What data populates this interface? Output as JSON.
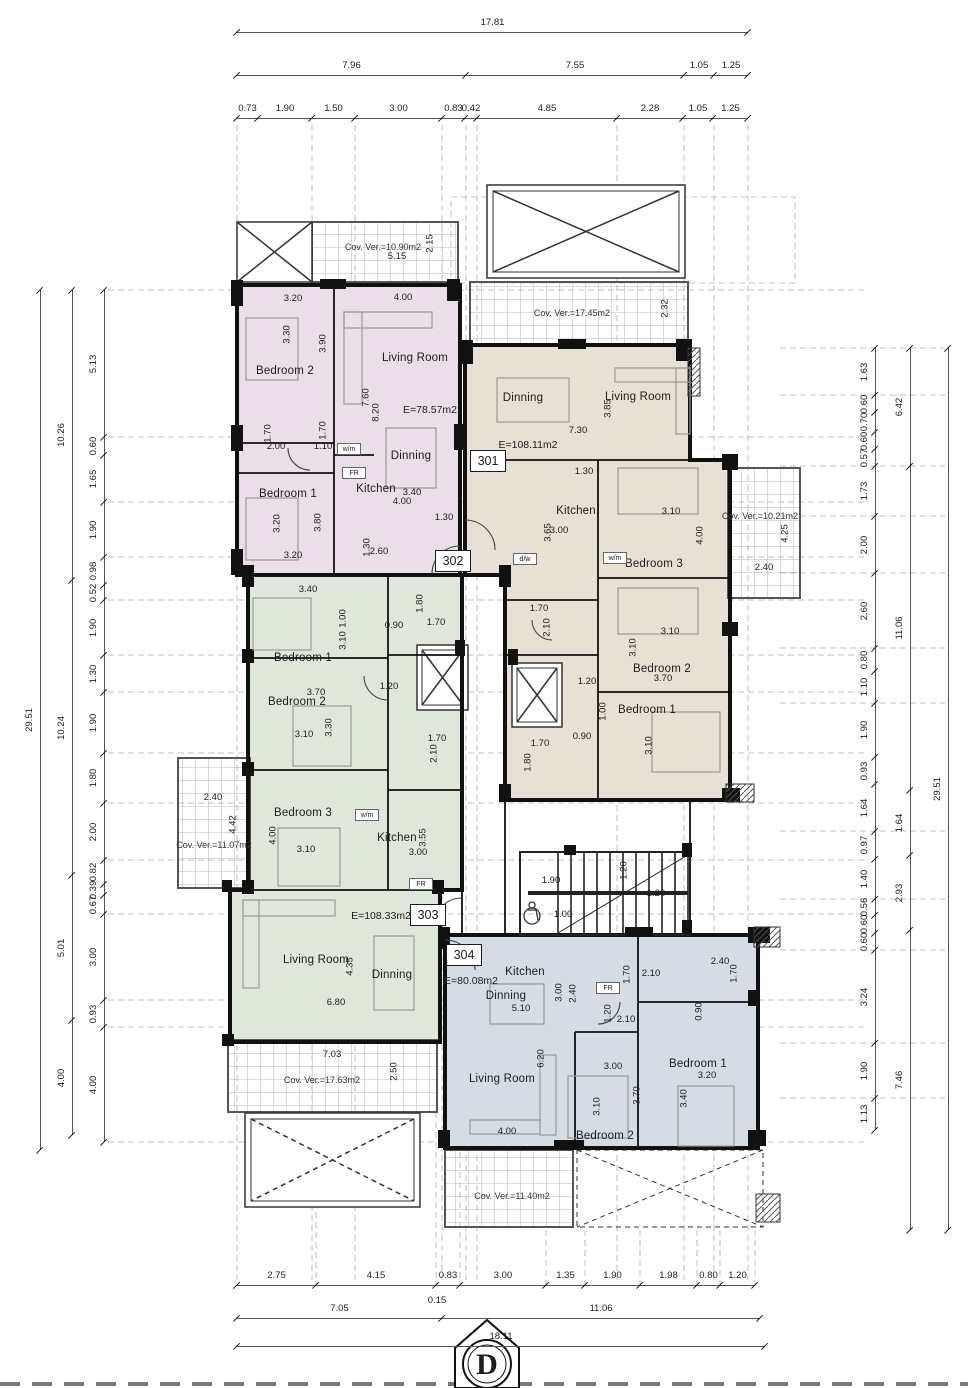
{
  "meta": {
    "section_marker": "D"
  },
  "colors": {
    "regions": {
      "apt-301-region": "#e6e0d5",
      "apt-302-region": "#eadee8",
      "apt-303-region": "#dfe6da",
      "apt-304-region": "#d6dce4"
    },
    "wall": "#111111",
    "dim_line": "#555555",
    "hatch_line": "#aaaaaa"
  },
  "apartments": [
    {
      "id": "301",
      "area_label": "E=108.11m2",
      "badge": {
        "x": 487,
        "y": 460
      },
      "area_pos": {
        "x": 528,
        "y": 445
      }
    },
    {
      "id": "302",
      "area_label": "E=78.57m2",
      "badge": {
        "x": 452,
        "y": 560
      },
      "area_pos": {
        "x": 430,
        "y": 410
      }
    },
    {
      "id": "303",
      "area_label": "E=108.33m2",
      "badge": {
        "x": 427,
        "y": 914
      },
      "area_pos": {
        "x": 381,
        "y": 916
      }
    },
    {
      "id": "304",
      "area_label": "E=80.08m2",
      "badge": {
        "x": 463,
        "y": 954
      },
      "area_pos": {
        "x": 471,
        "y": 981
      }
    }
  ],
  "labels": [
    {
      "t": "Cov. Ver.=10.90m2",
      "x": 383,
      "y": 247,
      "cls": "cov"
    },
    {
      "t": "5.15",
      "x": 397,
      "y": 257,
      "cls": "dim"
    },
    {
      "t": "2.15",
      "x": 430,
      "y": 243,
      "cls": "dim",
      "r": 1
    },
    {
      "t": "Bedroom 2",
      "x": 285,
      "y": 372,
      "cls": "room"
    },
    {
      "t": "Living Room",
      "x": 415,
      "y": 359,
      "cls": "room"
    },
    {
      "t": "Dinning",
      "x": 411,
      "y": 457,
      "cls": "room"
    },
    {
      "t": "Kitchen",
      "x": 376,
      "y": 490,
      "cls": "room"
    },
    {
      "t": "Bedroom 1",
      "x": 288,
      "y": 495,
      "cls": "room"
    },
    {
      "t": "3.20",
      "x": 293,
      "y": 299,
      "cls": "dim"
    },
    {
      "t": "4.00",
      "x": 403,
      "y": 298,
      "cls": "dim"
    },
    {
      "t": "3.30",
      "x": 287,
      "y": 334,
      "cls": "dim",
      "r": 1
    },
    {
      "t": "3.90",
      "x": 323,
      "y": 343,
      "cls": "dim",
      "r": 1
    },
    {
      "t": "7.60",
      "x": 366,
      "y": 397,
      "cls": "dim",
      "r": 1
    },
    {
      "t": "8.20",
      "x": 376,
      "y": 412,
      "cls": "dim",
      "r": 1
    },
    {
      "t": "1.70",
      "x": 268,
      "y": 433,
      "cls": "dim",
      "r": 1
    },
    {
      "t": "2.00",
      "x": 276,
      "y": 447,
      "cls": "dim"
    },
    {
      "t": "1.70",
      "x": 323,
      "y": 430,
      "cls": "dim",
      "r": 1
    },
    {
      "t": "1.10",
      "x": 323,
      "y": 447,
      "cls": "dim"
    },
    {
      "t": "3.40",
      "x": 412,
      "y": 493,
      "cls": "dim"
    },
    {
      "t": "4.00",
      "x": 402,
      "y": 502,
      "cls": "dim"
    },
    {
      "t": "1.30",
      "x": 444,
      "y": 518,
      "cls": "dim"
    },
    {
      "t": "3.80",
      "x": 318,
      "y": 522,
      "cls": "dim",
      "r": 1
    },
    {
      "t": "3.20",
      "x": 277,
      "y": 523,
      "cls": "dim",
      "r": 1
    },
    {
      "t": "3.20",
      "x": 293,
      "y": 556,
      "cls": "dim"
    },
    {
      "t": "1.30",
      "x": 367,
      "y": 547,
      "cls": "dim",
      "r": 1
    },
    {
      "t": "2.60",
      "x": 379,
      "y": 552,
      "cls": "dim"
    },
    {
      "t": "w/m",
      "x": 347,
      "y": 448,
      "cls": "fix"
    },
    {
      "t": "FR",
      "x": 352,
      "y": 472,
      "cls": "fix"
    },
    {
      "t": "Cov. Ver.=17.45m2",
      "x": 572,
      "y": 313,
      "cls": "cov"
    },
    {
      "t": "2.32",
      "x": 665,
      "y": 308,
      "cls": "dim",
      "r": 1
    },
    {
      "t": "Dinning",
      "x": 523,
      "y": 399,
      "cls": "room"
    },
    {
      "t": "Living Room",
      "x": 638,
      "y": 398,
      "cls": "room"
    },
    {
      "t": "7.30",
      "x": 578,
      "y": 431,
      "cls": "dim"
    },
    {
      "t": "3.85",
      "x": 608,
      "y": 408,
      "cls": "dim",
      "r": 1
    },
    {
      "t": "1.30",
      "x": 584,
      "y": 472,
      "cls": "dim"
    },
    {
      "t": "Kitchen",
      "x": 576,
      "y": 512,
      "cls": "room"
    },
    {
      "t": "3.65",
      "x": 548,
      "y": 532,
      "cls": "dim",
      "r": 1
    },
    {
      "t": "3.00",
      "x": 559,
      "y": 531,
      "cls": "dim"
    },
    {
      "t": "Bedroom 3",
      "x": 654,
      "y": 565,
      "cls": "room"
    },
    {
      "t": "3.10",
      "x": 671,
      "y": 512,
      "cls": "dim"
    },
    {
      "t": "4.00",
      "x": 700,
      "y": 535,
      "cls": "dim",
      "r": 1
    },
    {
      "t": "Cov. Ver.=10.21m2",
      "x": 760,
      "y": 516,
      "cls": "cov"
    },
    {
      "t": "4.25",
      "x": 785,
      "y": 533,
      "cls": "dim",
      "r": 1
    },
    {
      "t": "2.40",
      "x": 764,
      "y": 568,
      "cls": "dim"
    },
    {
      "t": "w/m",
      "x": 613,
      "y": 557,
      "cls": "fix"
    },
    {
      "t": "d/w",
      "x": 523,
      "y": 558,
      "cls": "fix"
    },
    {
      "t": "1.70",
      "x": 539,
      "y": 609,
      "cls": "dim"
    },
    {
      "t": "2.10",
      "x": 547,
      "y": 627,
      "cls": "dim",
      "r": 1
    },
    {
      "t": "Bedroom 2",
      "x": 662,
      "y": 670,
      "cls": "room"
    },
    {
      "t": "3.10",
      "x": 670,
      "y": 632,
      "cls": "dim"
    },
    {
      "t": "3.10",
      "x": 633,
      "y": 647,
      "cls": "dim",
      "r": 1
    },
    {
      "t": "3.70",
      "x": 663,
      "y": 679,
      "cls": "dim"
    },
    {
      "t": "Bedroom 1",
      "x": 647,
      "y": 711,
      "cls": "room"
    },
    {
      "t": "1.20",
      "x": 587,
      "y": 682,
      "cls": "dim"
    },
    {
      "t": "1.00",
      "x": 603,
      "y": 711,
      "cls": "dim",
      "r": 1
    },
    {
      "t": "0.90",
      "x": 582,
      "y": 737,
      "cls": "dim"
    },
    {
      "t": "3.10",
      "x": 649,
      "y": 745,
      "cls": "dim",
      "r": 1
    },
    {
      "t": "1.70",
      "x": 540,
      "y": 744,
      "cls": "dim"
    },
    {
      "t": "1.80",
      "x": 528,
      "y": 762,
      "cls": "dim",
      "r": 1
    },
    {
      "t": "1.90",
      "x": 551,
      "y": 881,
      "cls": "dim"
    },
    {
      "t": "1.20",
      "x": 624,
      "y": 870,
      "cls": "dim",
      "r": 1
    },
    {
      "t": "1.20",
      "x": 656,
      "y": 894,
      "cls": "dim"
    },
    {
      "t": "1.00",
      "x": 563,
      "y": 915,
      "cls": "dim"
    },
    {
      "t": "Bedroom 1",
      "x": 303,
      "y": 659,
      "cls": "room"
    },
    {
      "t": "3.40",
      "x": 308,
      "y": 590,
      "cls": "dim"
    },
    {
      "t": "3.10",
      "x": 343,
      "y": 640,
      "cls": "dim",
      "r": 1
    },
    {
      "t": "1.00",
      "x": 343,
      "y": 618,
      "cls": "dim",
      "r": 1
    },
    {
      "t": "0.90",
      "x": 394,
      "y": 626,
      "cls": "dim"
    },
    {
      "t": "1.80",
      "x": 420,
      "y": 603,
      "cls": "dim",
      "r": 1
    },
    {
      "t": "1.70",
      "x": 436,
      "y": 623,
      "cls": "dim"
    },
    {
      "t": "Bedroom 2",
      "x": 297,
      "y": 703,
      "cls": "room"
    },
    {
      "t": "3.70",
      "x": 316,
      "y": 693,
      "cls": "dim"
    },
    {
      "t": "1.20",
      "x": 389,
      "y": 687,
      "cls": "dim"
    },
    {
      "t": "3.10",
      "x": 304,
      "y": 735,
      "cls": "dim"
    },
    {
      "t": "3.30",
      "x": 329,
      "y": 727,
      "cls": "dim",
      "r": 1
    },
    {
      "t": "1.70",
      "x": 437,
      "y": 739,
      "cls": "dim"
    },
    {
      "t": "2.10",
      "x": 434,
      "y": 753,
      "cls": "dim",
      "r": 1
    },
    {
      "t": "Cov. Ver.=11.07m2",
      "x": 214,
      "y": 845,
      "cls": "cov"
    },
    {
      "t": "2.40",
      "x": 213,
      "y": 798,
      "cls": "dim"
    },
    {
      "t": "4.42",
      "x": 233,
      "y": 824,
      "cls": "dim",
      "r": 1
    },
    {
      "t": "Bedroom 3",
      "x": 303,
      "y": 814,
      "cls": "room"
    },
    {
      "t": "4.00",
      "x": 273,
      "y": 835,
      "cls": "dim",
      "r": 1
    },
    {
      "t": "3.10",
      "x": 306,
      "y": 850,
      "cls": "dim"
    },
    {
      "t": "Kitchen",
      "x": 397,
      "y": 839,
      "cls": "room"
    },
    {
      "t": "3.55",
      "x": 423,
      "y": 837,
      "cls": "dim",
      "r": 1
    },
    {
      "t": "3.00",
      "x": 418,
      "y": 853,
      "cls": "dim"
    },
    {
      "t": "w/m",
      "x": 365,
      "y": 814,
      "cls": "fix"
    },
    {
      "t": "FR",
      "x": 419,
      "y": 883,
      "cls": "fix"
    },
    {
      "t": "Living Room",
      "x": 316,
      "y": 961,
      "cls": "room"
    },
    {
      "t": "4.35",
      "x": 350,
      "y": 966,
      "cls": "dim",
      "r": 1
    },
    {
      "t": "Dinning",
      "x": 392,
      "y": 976,
      "cls": "room"
    },
    {
      "t": "6.80",
      "x": 336,
      "y": 1003,
      "cls": "dim"
    },
    {
      "t": "Cov. Ver.=17.63m2",
      "x": 322,
      "y": 1080,
      "cls": "cov"
    },
    {
      "t": "7.03",
      "x": 332,
      "y": 1055,
      "cls": "dim"
    },
    {
      "t": "2.50",
      "x": 394,
      "y": 1071,
      "cls": "dim",
      "r": 1
    },
    {
      "t": "Kitchen",
      "x": 525,
      "y": 973,
      "cls": "room"
    },
    {
      "t": "3.00",
      "x": 559,
      "y": 992,
      "cls": "dim",
      "r": 1
    },
    {
      "t": "2.40",
      "x": 573,
      "y": 993,
      "cls": "dim",
      "r": 1
    },
    {
      "t": "Dinning",
      "x": 506,
      "y": 997,
      "cls": "room"
    },
    {
      "t": "5.10",
      "x": 521,
      "y": 1009,
      "cls": "dim"
    },
    {
      "t": "1.70",
      "x": 627,
      "y": 974,
      "cls": "dim",
      "r": 1
    },
    {
      "t": "2.10",
      "x": 651,
      "y": 974,
      "cls": "dim"
    },
    {
      "t": "FR",
      "x": 606,
      "y": 987,
      "cls": "fix"
    },
    {
      "t": "1.20",
      "x": 608,
      "y": 1013,
      "cls": "dim",
      "r": 1
    },
    {
      "t": "2.10",
      "x": 626,
      "y": 1020,
      "cls": "dim"
    },
    {
      "t": "2.40",
      "x": 720,
      "y": 962,
      "cls": "dim"
    },
    {
      "t": "1.70",
      "x": 734,
      "y": 973,
      "cls": "dim",
      "r": 1
    },
    {
      "t": "0.90",
      "x": 699,
      "y": 1011,
      "cls": "dim",
      "r": 1
    },
    {
      "t": "Living Room",
      "x": 502,
      "y": 1080,
      "cls": "room"
    },
    {
      "t": "6.20",
      "x": 541,
      "y": 1058,
      "cls": "dim",
      "r": 1
    },
    {
      "t": "4.00",
      "x": 507,
      "y": 1132,
      "cls": "dim"
    },
    {
      "t": "3.00",
      "x": 613,
      "y": 1067,
      "cls": "dim"
    },
    {
      "t": "3.10",
      "x": 597,
      "y": 1106,
      "cls": "dim",
      "r": 1
    },
    {
      "t": "3.70",
      "x": 637,
      "y": 1095,
      "cls": "dim",
      "r": 1
    },
    {
      "t": "Bedroom 2",
      "x": 605,
      "y": 1137,
      "cls": "room"
    },
    {
      "t": "Bedroom 1",
      "x": 698,
      "y": 1065,
      "cls": "room"
    },
    {
      "t": "3.20",
      "x": 707,
      "y": 1076,
      "cls": "dim"
    },
    {
      "t": "3.40",
      "x": 684,
      "y": 1098,
      "cls": "dim",
      "r": 1
    },
    {
      "t": "Cov. Ver.=11.40m2",
      "x": 512,
      "y": 1196,
      "cls": "cov"
    },
    {
      "t": "0.15",
      "x": 437,
      "y": 1301,
      "cls": "dim"
    }
  ],
  "dim_chains": [
    {
      "name": "top-overall",
      "axis": "h",
      "pos": 32,
      "ticks": [
        237,
        748
      ],
      "values": [
        "17.81"
      ]
    },
    {
      "name": "top-mid",
      "axis": "h",
      "pos": 75,
      "ticks": [
        237,
        466,
        684,
        714,
        748
      ],
      "values": [
        "7.96",
        "7.55",
        "1.05",
        "1.25"
      ]
    },
    {
      "name": "top-detail",
      "axis": "h",
      "pos": 118,
      "ticks": [
        237,
        258,
        312,
        355,
        442,
        465,
        477,
        617,
        683,
        713,
        748
      ],
      "values": [
        "0.73",
        "1.90",
        "1.50",
        "3.00",
        "0.83",
        "0.42",
        "4.85",
        "2.28",
        "1.05",
        "1.25"
      ]
    },
    {
      "name": "bottom-detail",
      "axis": "h",
      "pos": 1285,
      "ticks": [
        237,
        316,
        436,
        460,
        546,
        585,
        640,
        697,
        720,
        755
      ],
      "values": [
        "2.75",
        "4.15",
        "0.83",
        "3.00",
        "1.35",
        "1.90",
        "1.98",
        "0.80",
        "1.20"
      ]
    },
    {
      "name": "bottom-mid",
      "axis": "h",
      "pos": 1318,
      "ticks": [
        237,
        442,
        760
      ],
      "values": [
        "7.05",
        "11.06"
      ]
    },
    {
      "name": "bottom-overall",
      "axis": "h",
      "pos": 1346,
      "ticks": [
        237,
        765
      ],
      "values": [
        "18.11"
      ]
    },
    {
      "name": "left-overall",
      "axis": "v",
      "pos": 40,
      "ticks": [
        290,
        1150
      ],
      "values": [
        "29.51"
      ]
    },
    {
      "name": "left-mid",
      "axis": "v",
      "pos": 72,
      "ticks": [
        290,
        580,
        875,
        1020,
        1135
      ],
      "values": [
        "10.26",
        "10.24",
        "5.01",
        "4.00"
      ]
    },
    {
      "name": "left-detail",
      "axis": "v",
      "pos": 104,
      "ticks": [
        290,
        437,
        455,
        502,
        557,
        585,
        600,
        655,
        692,
        753,
        803,
        860,
        884,
        895,
        914,
        1000,
        1027,
        1142
      ],
      "values": [
        "5.13",
        "0.60",
        "1.65",
        "1.90",
        "0.98",
        "0.52",
        "1.90",
        "1.30",
        "1.90",
        "1.80",
        "2.00",
        "0.82",
        "0.39",
        "0.67",
        "3.00",
        "0.93",
        "4.00"
      ]
    },
    {
      "name": "right-detail",
      "axis": "v",
      "pos": 875,
      "ticks": [
        348,
        395,
        412,
        432,
        449,
        466,
        516,
        573,
        648,
        671,
        703,
        757,
        784,
        831,
        859,
        899,
        915,
        933,
        950,
        1043,
        1098,
        1130
      ],
      "values": [
        "1.63",
        "0.60",
        "0.70",
        "0.60",
        "0.57",
        "1.73",
        "2.00",
        "2.60",
        "0.80",
        "1.10",
        "1.90",
        "0.93",
        "1.64",
        "0.97",
        "1.40",
        "0.56",
        "0.60",
        "0.60",
        "3.24",
        "1.90",
        "1.13"
      ]
    },
    {
      "name": "right-mid",
      "axis": "v",
      "pos": 910,
      "ticks": [
        348,
        466,
        790,
        855,
        930,
        1230
      ],
      "values": [
        "6.42",
        "11.06",
        "1.64",
        "2.93",
        "7.46"
      ]
    },
    {
      "name": "right-overall",
      "axis": "v",
      "pos": 948,
      "ticks": [
        348,
        1230
      ],
      "values": [
        "29.51"
      ]
    }
  ]
}
